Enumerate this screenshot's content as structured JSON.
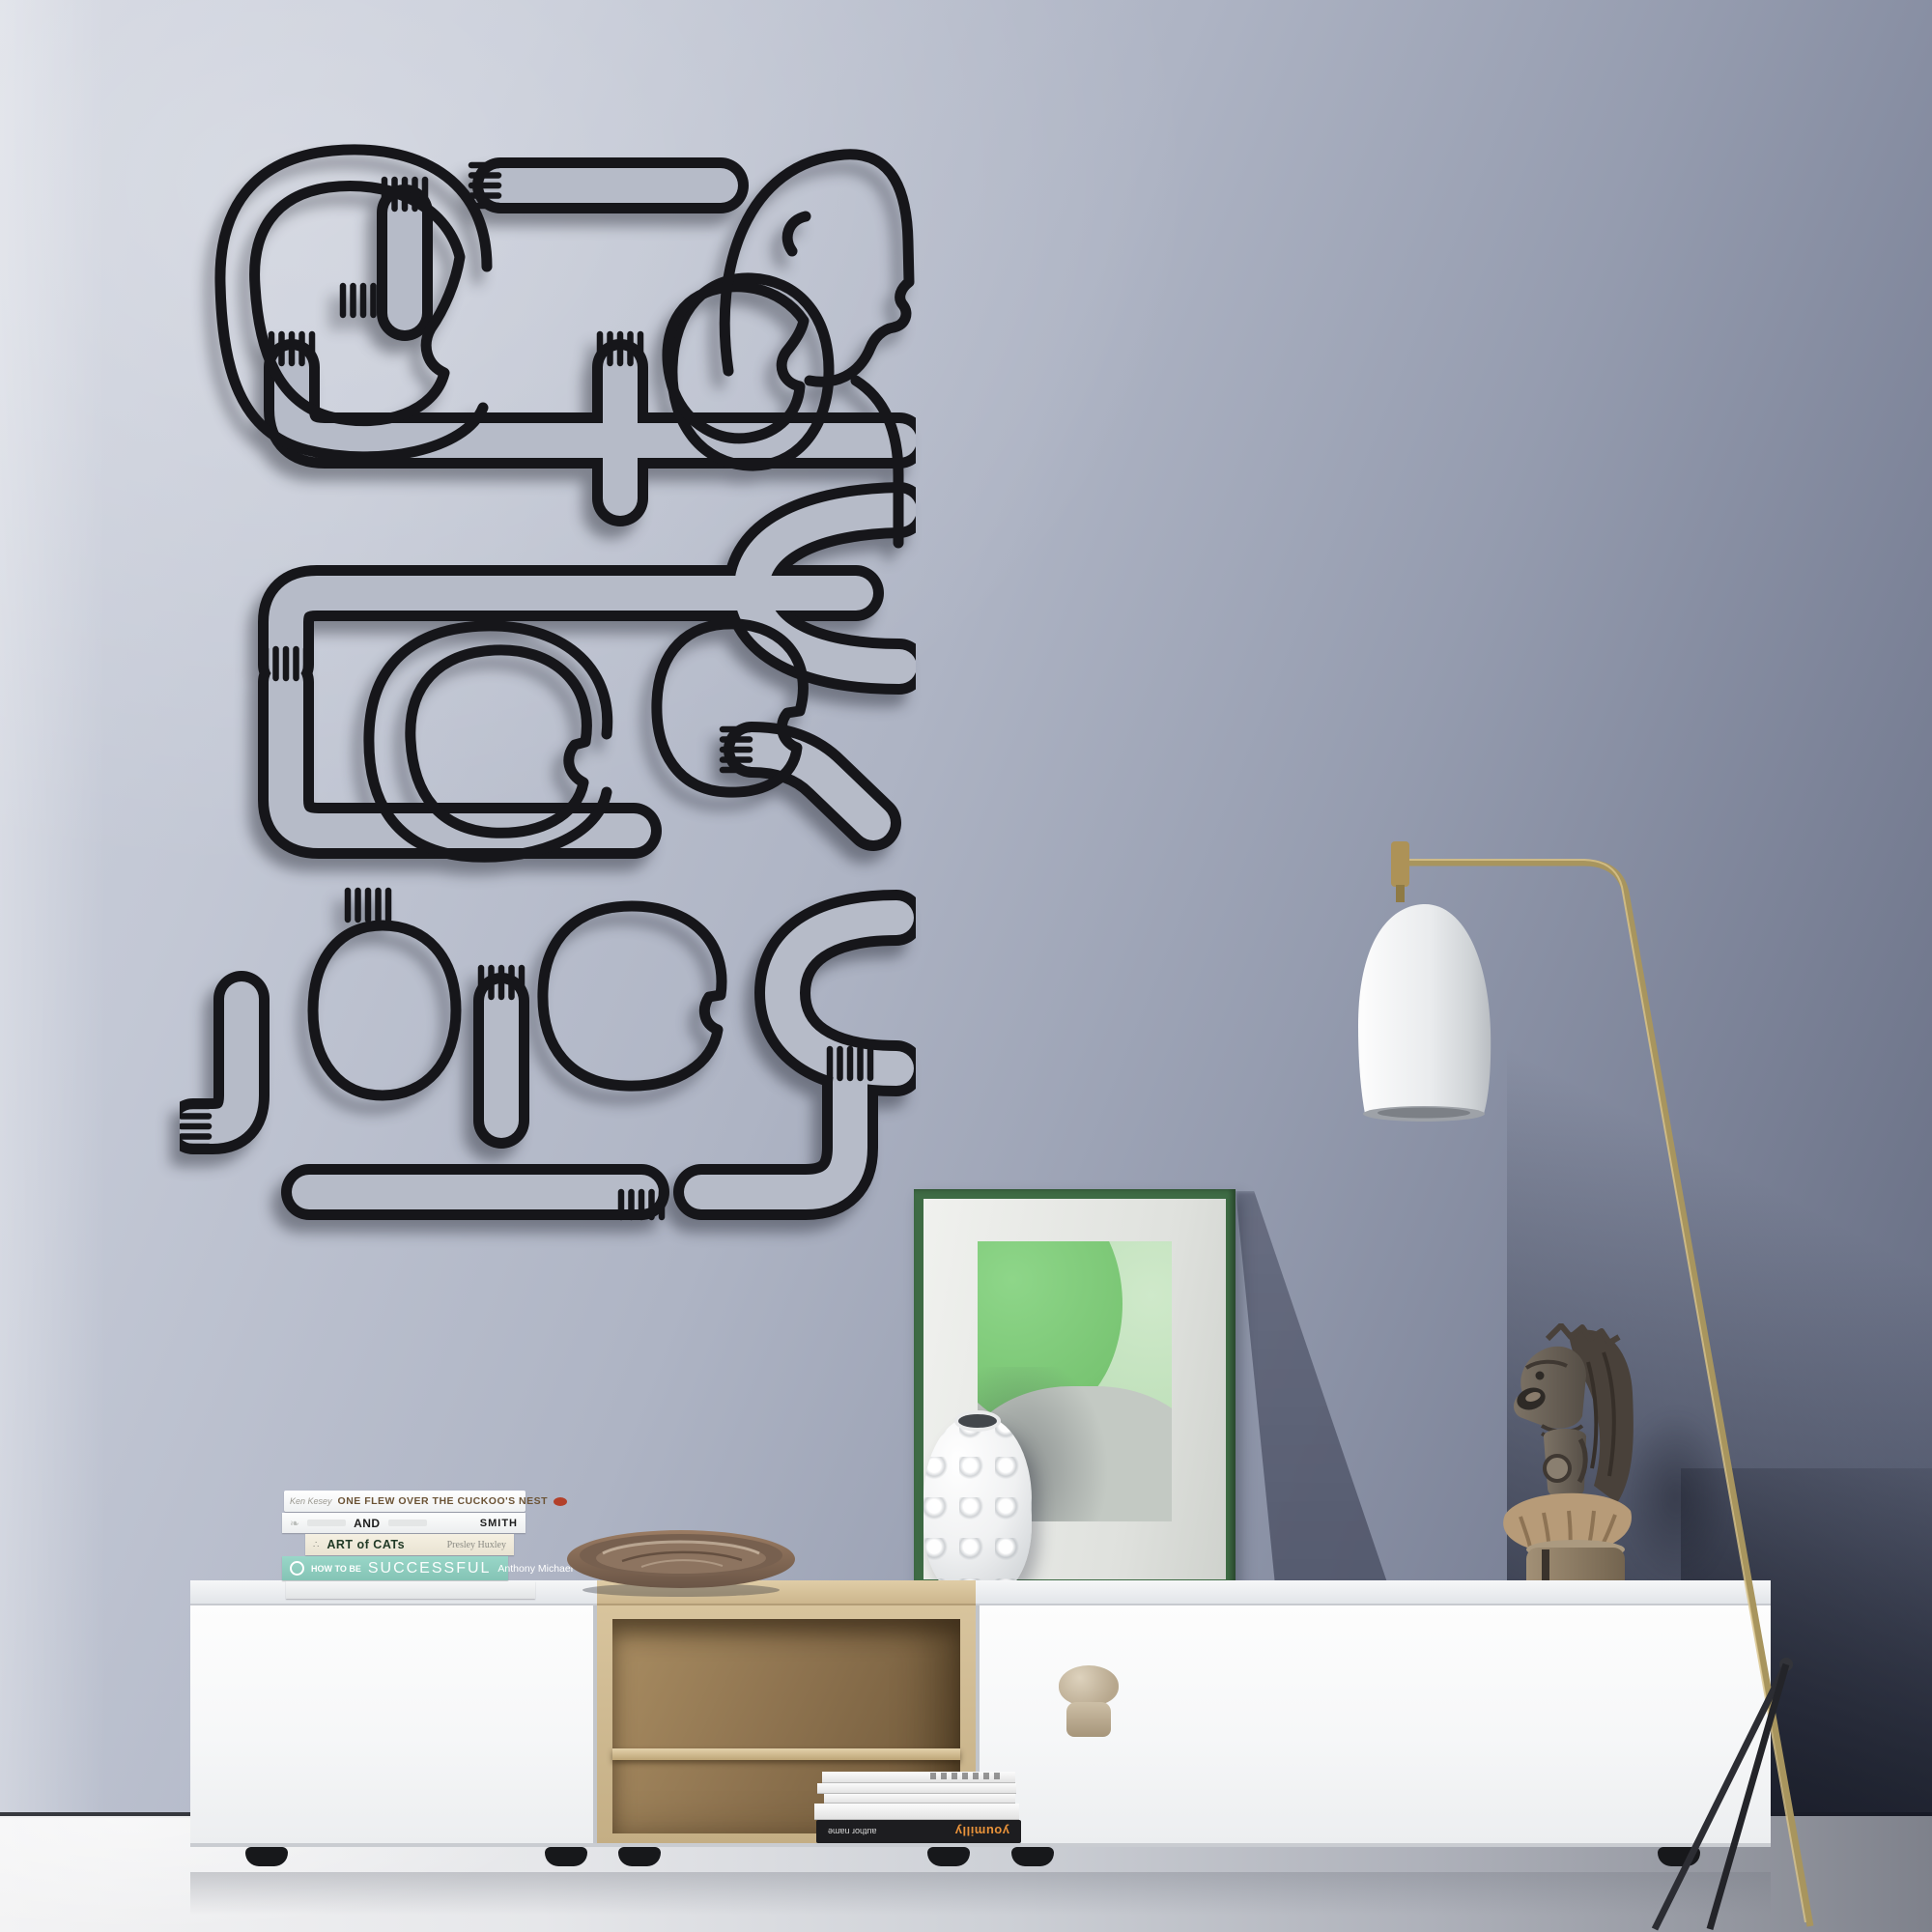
{
  "scene": {
    "description": "Living room product photo: black line-art metal wall decor of intertwined hugging figures on a blue-grey wall above a long white sideboard with oak open shelf, styled with books, wooden bowl, framed green abstract print, white bubble vase, tribal wooden statue and a brass floor lamp with white shade.",
    "palette": {
      "wall_light": "#cdd1dc",
      "wall_mid": "#9aa1b3",
      "wall_shadow": "#3d4253",
      "floor_light": "#f3f3f4",
      "floor_dark": "#7e818b",
      "art_line": "#16161a"
    }
  },
  "wall_art": {
    "name": "line-art hugging figures metal wall decor",
    "line_color": "#16161a",
    "figure_count": 7,
    "hand_count": 12
  },
  "books": {
    "items": [
      {
        "author": "Ken Kesey",
        "title": "ONE FLEW OVER THE CUCKOO'S NEST",
        "spine_color": "#ffffff",
        "accent_color": "#b3402a"
      },
      {
        "word": "AND",
        "author": "SMITH",
        "spine_color": "#fbfbfb"
      },
      {
        "title": "ART of CATs",
        "author": "Presley Huxley",
        "spine_color": "#f1ecdc"
      },
      {
        "tagline": "HOW TO BE",
        "title": "SUCCESSFUL",
        "author": "Anthony Michael",
        "spine_color": "#8fd0c2"
      },
      {
        "title": "",
        "spine_color": "#f4f5f5"
      }
    ]
  },
  "magazines": {
    "spine_title": "youmilly",
    "spine_title_color": "#e8923a",
    "spine_author_label": "author name"
  },
  "framed_print": {
    "frame_color": "#3e6b44",
    "mat_color": "#f0f1ee",
    "art_colors": [
      "#8ed689",
      "#cfe9ca",
      "#c3c9c3"
    ]
  },
  "furniture": {
    "sideboard_color": "#f8f9fa",
    "oak_color": "#d8c49d",
    "feet_color": "#17181b"
  },
  "objects": {
    "bowl": "wooden bowl",
    "vase": "white bubble vase",
    "statue": "tribal wooden statue",
    "shelf_object": "stone mushroom object",
    "lamp": "brass floor lamp with white shade"
  },
  "lamp": {
    "stem_color": "#a8955e",
    "shade_color": "#f3f4f5",
    "tripod_color": "#2c2d33"
  }
}
